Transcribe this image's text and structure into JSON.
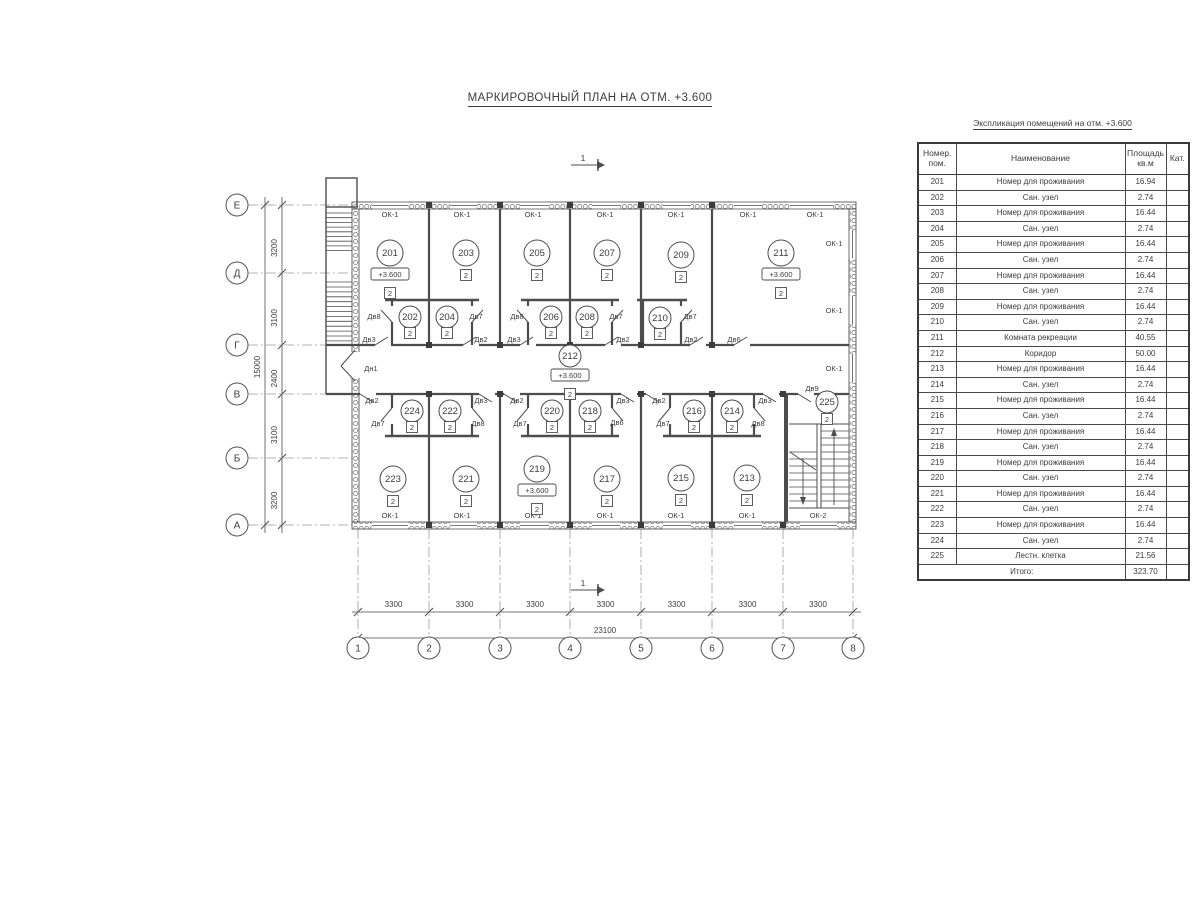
{
  "title": "МАРКИРОВОЧНЫЙ ПЛАН НА ОТМ. +3.600",
  "section_mark_label": "1",
  "schedule": {
    "title": "Экспликация помещений на отм. +3.600",
    "col_headers": [
      "Номер. пом.",
      "Наименование",
      "Площадь кв.м",
      "Кат."
    ],
    "rows": [
      [
        "201",
        "Номер для проживания",
        "16.94",
        ""
      ],
      [
        "202",
        "Сан. узел",
        "2.74",
        ""
      ],
      [
        "203",
        "Номер для проживания",
        "16.44",
        ""
      ],
      [
        "204",
        "Сан. узел",
        "2.74",
        ""
      ],
      [
        "205",
        "Номер для проживания",
        "16.44",
        ""
      ],
      [
        "206",
        "Сан. узел",
        "2.74",
        ""
      ],
      [
        "207",
        "Номер для проживания",
        "16.44",
        ""
      ],
      [
        "208",
        "Сан. узел",
        "2.74",
        ""
      ],
      [
        "209",
        "Номер для проживания",
        "16.44",
        ""
      ],
      [
        "210",
        "Сан. узел",
        "2.74",
        ""
      ],
      [
        "211",
        "Комната рекреации",
        "40.55",
        ""
      ],
      [
        "212",
        "Коридор",
        "50.00",
        ""
      ],
      [
        "213",
        "Номер для проживания",
        "16.44",
        ""
      ],
      [
        "214",
        "Сан. узел",
        "2.74",
        ""
      ],
      [
        "215",
        "Номер для проживания",
        "16.44",
        ""
      ],
      [
        "216",
        "Сан. узел",
        "2.74",
        ""
      ],
      [
        "217",
        "Номер для проживания",
        "16.44",
        ""
      ],
      [
        "218",
        "Сан. узел",
        "2.74",
        ""
      ],
      [
        "219",
        "Номер для проживания",
        "16.44",
        ""
      ],
      [
        "220",
        "Сан. узел",
        "2.74",
        ""
      ],
      [
        "221",
        "Номер для проживания",
        "16.44",
        ""
      ],
      [
        "222",
        "Сан. узел",
        "2.74",
        ""
      ],
      [
        "223",
        "Номер для проживания",
        "16.44",
        ""
      ],
      [
        "224",
        "Сан. узел",
        "2.74",
        ""
      ],
      [
        "225",
        "Лестн. клетка",
        "21.56",
        ""
      ]
    ],
    "total_label": "Итого:",
    "total_area": "323.70"
  },
  "plan": {
    "elevation_tag": "+3.600",
    "category": "2",
    "rooms": [
      "201",
      "203",
      "205",
      "207",
      "209",
      "211",
      "202",
      "204",
      "206",
      "208",
      "210",
      "212",
      "224",
      "222",
      "220",
      "218",
      "216",
      "214",
      "223",
      "221",
      "219",
      "217",
      "215",
      "213",
      "225"
    ],
    "window_types": {
      "ok1": "ОК-1",
      "ok2": "ОК-2"
    },
    "door_types": {
      "dv2": "Дв2",
      "dv3": "Дв3",
      "dv6": "Дв6",
      "dv7": "Дв7",
      "dv8": "Дв8",
      "dv9": "Дв9",
      "dn1": "Дн1"
    },
    "axes_rows": [
      "Е",
      "Д",
      "Г",
      "В",
      "Б",
      "А"
    ],
    "axes_cols": [
      "1",
      "2",
      "3",
      "4",
      "5",
      "6",
      "7",
      "8"
    ],
    "dims_left": [
      "3200",
      "3100",
      "2400",
      "3100",
      "3200"
    ],
    "dim_left_total": "15000",
    "dims_bottom": [
      "3300",
      "3300",
      "3300",
      "3300",
      "3300",
      "3300",
      "3300"
    ],
    "dim_bottom_total": "23100"
  }
}
